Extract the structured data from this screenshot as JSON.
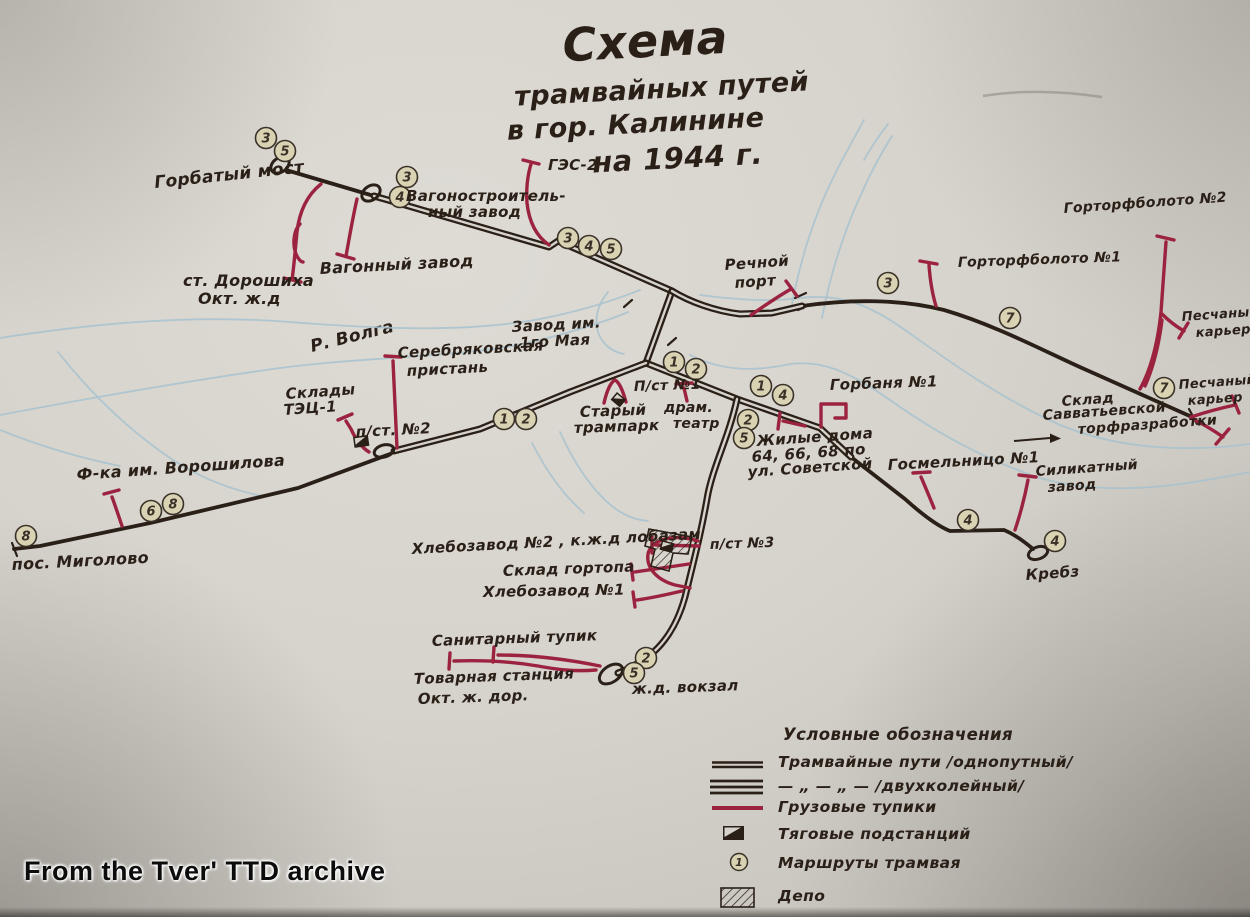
{
  "title": {
    "l1": "Схема",
    "l2": "трамвайных путей",
    "l3": "в гор. Калинине",
    "l4": "на 1944 г."
  },
  "watermark": {
    "text": "From the Tver' TTD archive"
  },
  "river": {
    "name": "Р. Волга"
  },
  "legend": {
    "title": "Условные обозначения",
    "items": [
      {
        "type": "single",
        "label": "Трамвайные пути /однопутный/"
      },
      {
        "type": "triple",
        "label": "— „ — „ —   /двухколейный/"
      },
      {
        "type": "red",
        "label": "Грузовые тупики"
      },
      {
        "type": "substation",
        "label": "Тяговые подстанций"
      },
      {
        "type": "badge",
        "label": "Маршруты трамвая",
        "badge_number": "1"
      },
      {
        "type": "depot",
        "label": "Депо"
      }
    ]
  },
  "colors": {
    "ink": "#2a2018",
    "red": "#9c2340",
    "river": "#a7c2cf",
    "river_text": "#7ea9bd",
    "paper": "#d6d3cc",
    "badge_fill": "#d9d3b4"
  },
  "map": {
    "double_tracks": [
      "M374,196 L549,247 L558,241 L672,291",
      "M672,291 L646,363",
      "M672,291 C690,302 715,311 740,314 L772,313 L802,306",
      "M646,363 L737,399 L820,428 L851,457",
      "M737,399 C729,437 712,468 707,499 C701,533 694,560 685,597 C677,626 662,649 640,662 C632,667 624,671 618,673",
      "M646,363 L570,392 L480,429 L394,451"
    ],
    "single_tracks": [
      "M286,170 L374,196",
      "M390,454 L298,488 L150,523 L40,546 L14,549",
      "M802,306 C850,299 900,299 944,310 C995,325 1042,350 1082,368 L1192,417",
      "M851,457 L905,499 C925,517 940,527 950,531 L1004,530 C1016,535 1026,543 1033,549"
    ],
    "freight": [
      "M321,184 C306,196 299,214 297,232 C295,252 294,266 292,280 M284,278 L301,282 M300,224 C294,230 292,243 296,254 C298,259 301,262 303,262",
      "M357,199 C352,221 349,240 346,256 M337,254 L354,259",
      "M549,245 C536,236 529,221 527,203 C526,188 528,174 531,164 M523,160 L539,164",
      "M751,315 C764,306 777,297 791,289 M786,281 L797,296",
      "M936,306 C932,293 930,279 929,265 M920,261 L937,264",
      "M1140,389 C1151,369 1158,341 1161,312 L1166,242 M1157,236 L1174,240 M1145,386 C1153,368 1159,344 1162,320 M1162,314 C1170,322 1177,327 1184,331 M1179,338 L1188,323",
      "M1191,417 C1206,412 1221,408 1235,405 M1232,396 L1239,413 M1191,418 C1203,424 1213,430 1223,437 M1229,429 L1216,444",
      "M821,427 L821,404 L846,404 L846,418 L835,418",
      "M805,426 L783,421 M780,413 L778,429",
      "M934,508 C929,496 925,486 921,477 M913,473 L930,472",
      "M1015,530 C1021,512 1025,496 1028,480 M1019,475 L1036,477",
      "M122,526 C118,514 115,505 112,497 M104,494 L119,490",
      "M397,448 L393,361 M385,356 L401,357",
      "M369,452 C361,447 355,438 351,429 L346,421 M338,420 L352,414",
      "M604,403 C607,390 611,382 615,380 C619,382 623,391 626,402",
      "M687,401 L684,388 M676,384 L692,383",
      "M699,546 L656,545 M652,537 L652,553",
      "M689,564 L635,572 M631,564 L633,580",
      "M682,591 C665,595 651,598 637,600 M633,592 L635,607",
      "M600,666 C566,659 531,655 498,655 M494,647 L493,662",
      "M596,670 C572,672 555,669 538,666 C508,661 480,660 454,661 M450,653 L449,669",
      "M698,541 C672,533 651,540 648,554 C646,568 657,580 675,585 L690,588"
    ],
    "rivers": [
      "M0,338 C90,324 190,314 290,322 C380,329 470,333 545,318 C585,310 615,300 640,290",
      "M0,415 C90,398 180,382 280,368 C370,356 470,358 540,340 C575,331 605,322 628,312",
      "M700,295 C740,300 770,302 800,298 C840,293 870,305 905,330 C950,362 1000,398 1060,425 C1120,450 1190,452 1250,444",
      "M690,355 C720,370 750,372 785,365 C820,358 850,372 890,400 C935,432 985,460 1040,478 C1110,498 1185,485 1250,472",
      "M792,304 C800,262 814,215 836,172 C846,152 856,135 864,120",
      "M822,318 C830,276 844,230 864,188 C872,170 882,152 892,136",
      "M864,160 C872,146 881,133 888,124",
      "M58,352 C88,390 126,428 170,458 C200,478 232,490 262,496",
      "M0,430 C40,446 80,458 120,466",
      "M560,432 C572,458 586,482 606,501 C620,514 634,520 648,521",
      "M532,443 C546,470 562,494 584,513",
      "M608,292 C598,304 594,318 598,332 C602,344 612,352 624,354"
    ],
    "loops": [
      {
        "cx": 280,
        "cy": 165,
        "rx": 10,
        "ry": 7,
        "rot": -35
      },
      {
        "cx": 371,
        "cy": 193,
        "rx": 10,
        "ry": 7,
        "rot": -35
      },
      {
        "cx": 384,
        "cy": 451,
        "rx": 10,
        "ry": 6,
        "rot": -15
      },
      {
        "cx": 1038,
        "cy": 553,
        "rx": 10,
        "ry": 6,
        "rot": -20
      },
      {
        "cx": 611,
        "cy": 674,
        "rx": 13,
        "ry": 8,
        "rot": -35
      }
    ],
    "substations": [
      {
        "x": 353,
        "y": 437,
        "w": 15,
        "h": 11,
        "rot": -8
      },
      {
        "x": 617,
        "y": 392,
        "w": 12,
        "h": 10,
        "rot": 40
      },
      {
        "x": 662,
        "y": 540,
        "w": 13,
        "h": 10,
        "rot": 15
      }
    ],
    "depot": {
      "points": "649,529 692,537 688,554 673,553 669,571 651,566 655,549 645,546"
    },
    "arrow": {
      "x1": 1014,
      "y1": 441,
      "x2": 1050,
      "y2": 438
    },
    "ticks": [
      [
        12,
        543,
        17,
        556
      ],
      [
        1189,
        409,
        1197,
        424
      ],
      [
        795,
        298,
        806,
        293
      ],
      [
        798,
        310,
        809,
        305
      ],
      [
        632,
        300,
        624,
        307
      ],
      [
        676,
        338,
        668,
        345
      ]
    ],
    "stains": [
      "M983,96 C1020,90 1062,91 1102,97"
    ],
    "badges": [
      {
        "n": "3",
        "x": 266,
        "y": 138
      },
      {
        "n": "5",
        "x": 285,
        "y": 151
      },
      {
        "n": "3",
        "x": 407,
        "y": 177
      },
      {
        "n": "4",
        "x": 400,
        "y": 197
      },
      {
        "n": "3",
        "x": 568,
        "y": 238
      },
      {
        "n": "4",
        "x": 589,
        "y": 246
      },
      {
        "n": "5",
        "x": 611,
        "y": 249
      },
      {
        "n": "3",
        "x": 888,
        "y": 283
      },
      {
        "n": "7",
        "x": 1010,
        "y": 318
      },
      {
        "n": "1",
        "x": 674,
        "y": 362
      },
      {
        "n": "2",
        "x": 696,
        "y": 369
      },
      {
        "n": "1",
        "x": 761,
        "y": 386
      },
      {
        "n": "4",
        "x": 783,
        "y": 395
      },
      {
        "n": "2",
        "x": 748,
        "y": 420
      },
      {
        "n": "5",
        "x": 744,
        "y": 438
      },
      {
        "n": "1",
        "x": 504,
        "y": 419
      },
      {
        "n": "2",
        "x": 526,
        "y": 419
      },
      {
        "n": "6",
        "x": 151,
        "y": 511
      },
      {
        "n": "8",
        "x": 173,
        "y": 504
      },
      {
        "n": "8",
        "x": 26,
        "y": 536
      },
      {
        "n": "4",
        "x": 968,
        "y": 520
      },
      {
        "n": "4",
        "x": 1055,
        "y": 541
      },
      {
        "n": "2",
        "x": 646,
        "y": 658
      },
      {
        "n": "5",
        "x": 634,
        "y": 673
      },
      {
        "n": "7",
        "x": 1164,
        "y": 388
      }
    ],
    "labels": [
      {
        "t": "Горбатый мост",
        "x": 155,
        "y": 188,
        "s": 17,
        "r": -6
      },
      {
        "t": "ст. Дорошиха",
        "x": 183,
        "y": 286,
        "s": 16,
        "r": 0
      },
      {
        "t": "Окт. ж.д",
        "x": 198,
        "y": 304,
        "s": 16,
        "r": 0
      },
      {
        "t": "Вагонный завод",
        "x": 320,
        "y": 274,
        "s": 16,
        "r": -3
      },
      {
        "t": "Вагоностроитель-",
        "x": 406,
        "y": 201,
        "s": 15,
        "r": 0
      },
      {
        "t": "ный завод",
        "x": 428,
        "y": 217,
        "s": 15,
        "r": 0
      },
      {
        "t": "ГЭС-2",
        "x": 548,
        "y": 170,
        "s": 15,
        "r": 0
      },
      {
        "t": "Речной",
        "x": 725,
        "y": 270,
        "s": 15,
        "r": -4
      },
      {
        "t": "порт",
        "x": 735,
        "y": 288,
        "s": 15,
        "r": -4
      },
      {
        "t": "Горторфболото №2",
        "x": 1064,
        "y": 213,
        "s": 14,
        "r": -4
      },
      {
        "t": "Горторфболото №1",
        "x": 958,
        "y": 267,
        "s": 14,
        "r": -2
      },
      {
        "t": "Песчаный",
        "x": 1182,
        "y": 321,
        "s": 13,
        "r": -4
      },
      {
        "t": "карьер",
        "x": 1196,
        "y": 337,
        "s": 13,
        "r": -4
      },
      {
        "t": "Песчаный",
        "x": 1179,
        "y": 389,
        "s": 13,
        "r": -4
      },
      {
        "t": "карьер",
        "x": 1188,
        "y": 405,
        "s": 13,
        "r": -4
      },
      {
        "t": "Склад",
        "x": 1062,
        "y": 406,
        "s": 14,
        "r": -4
      },
      {
        "t": "Савватьевской",
        "x": 1043,
        "y": 420,
        "s": 14,
        "r": -4
      },
      {
        "t": "торфразработки",
        "x": 1078,
        "y": 434,
        "s": 14,
        "r": -4
      },
      {
        "t": "Горбаня №1",
        "x": 830,
        "y": 390,
        "s": 15,
        "r": -2
      },
      {
        "t": "Жилые дома",
        "x": 757,
        "y": 446,
        "s": 15,
        "r": -4
      },
      {
        "t": "64, 66, 68 по",
        "x": 752,
        "y": 462,
        "s": 15,
        "r": -4
      },
      {
        "t": "ул. Советской",
        "x": 748,
        "y": 477,
        "s": 15,
        "r": -4
      },
      {
        "t": "Госмельницо №1",
        "x": 888,
        "y": 470,
        "s": 15,
        "r": -3
      },
      {
        "t": "Силикатный",
        "x": 1036,
        "y": 476,
        "s": 14,
        "r": -4
      },
      {
        "t": "завод",
        "x": 1048,
        "y": 492,
        "s": 14,
        "r": -4
      },
      {
        "t": "Кребз",
        "x": 1026,
        "y": 580,
        "s": 15,
        "r": -4
      },
      {
        "t": "Ф-ка им. Ворошилова",
        "x": 77,
        "y": 480,
        "s": 16,
        "r": -4
      },
      {
        "t": "пос. Миголово",
        "x": 12,
        "y": 570,
        "s": 16,
        "r": -3
      },
      {
        "t": "Склады",
        "x": 286,
        "y": 399,
        "s": 15,
        "r": -4
      },
      {
        "t": "ТЭЦ-1",
        "x": 284,
        "y": 415,
        "s": 15,
        "r": -4
      },
      {
        "t": "п/ст. №2",
        "x": 356,
        "y": 437,
        "s": 15,
        "r": -3
      },
      {
        "t": "Серебряковская",
        "x": 398,
        "y": 358,
        "s": 15,
        "r": -3
      },
      {
        "t": "пристань",
        "x": 407,
        "y": 376,
        "s": 15,
        "r": -3
      },
      {
        "t": "Завод им.",
        "x": 512,
        "y": 332,
        "s": 15,
        "r": -3
      },
      {
        "t": "1го Мая",
        "x": 520,
        "y": 348,
        "s": 15,
        "r": -3
      },
      {
        "t": "Старый",
        "x": 580,
        "y": 417,
        "s": 15,
        "r": -2
      },
      {
        "t": "трампарк",
        "x": 574,
        "y": 433,
        "s": 15,
        "r": -2
      },
      {
        "t": "П/ст №1",
        "x": 634,
        "y": 391,
        "s": 14,
        "r": -2
      },
      {
        "t": "драм.",
        "x": 664,
        "y": 412,
        "s": 14,
        "r": 0
      },
      {
        "t": "театр",
        "x": 673,
        "y": 428,
        "s": 14,
        "r": 0
      },
      {
        "t": "Хлебозавод №2 , к.ж.д лобазам",
        "x": 412,
        "y": 554,
        "s": 15,
        "r": -3
      },
      {
        "t": "Склад гортопа",
        "x": 503,
        "y": 576,
        "s": 15,
        "r": -2
      },
      {
        "t": "Хлебозавод №1",
        "x": 483,
        "y": 597,
        "s": 15,
        "r": -1
      },
      {
        "t": "п/ст №3",
        "x": 710,
        "y": 549,
        "s": 14,
        "r": -2
      },
      {
        "t": "Санитарный тупик",
        "x": 432,
        "y": 646,
        "s": 15,
        "r": -2
      },
      {
        "t": "Товарная станция",
        "x": 414,
        "y": 684,
        "s": 15,
        "r": -2
      },
      {
        "t": "Окт. ж. дор.",
        "x": 418,
        "y": 704,
        "s": 15,
        "r": -2
      },
      {
        "t": "ж.д. вокзал",
        "x": 632,
        "y": 694,
        "s": 15,
        "r": -2
      }
    ]
  }
}
